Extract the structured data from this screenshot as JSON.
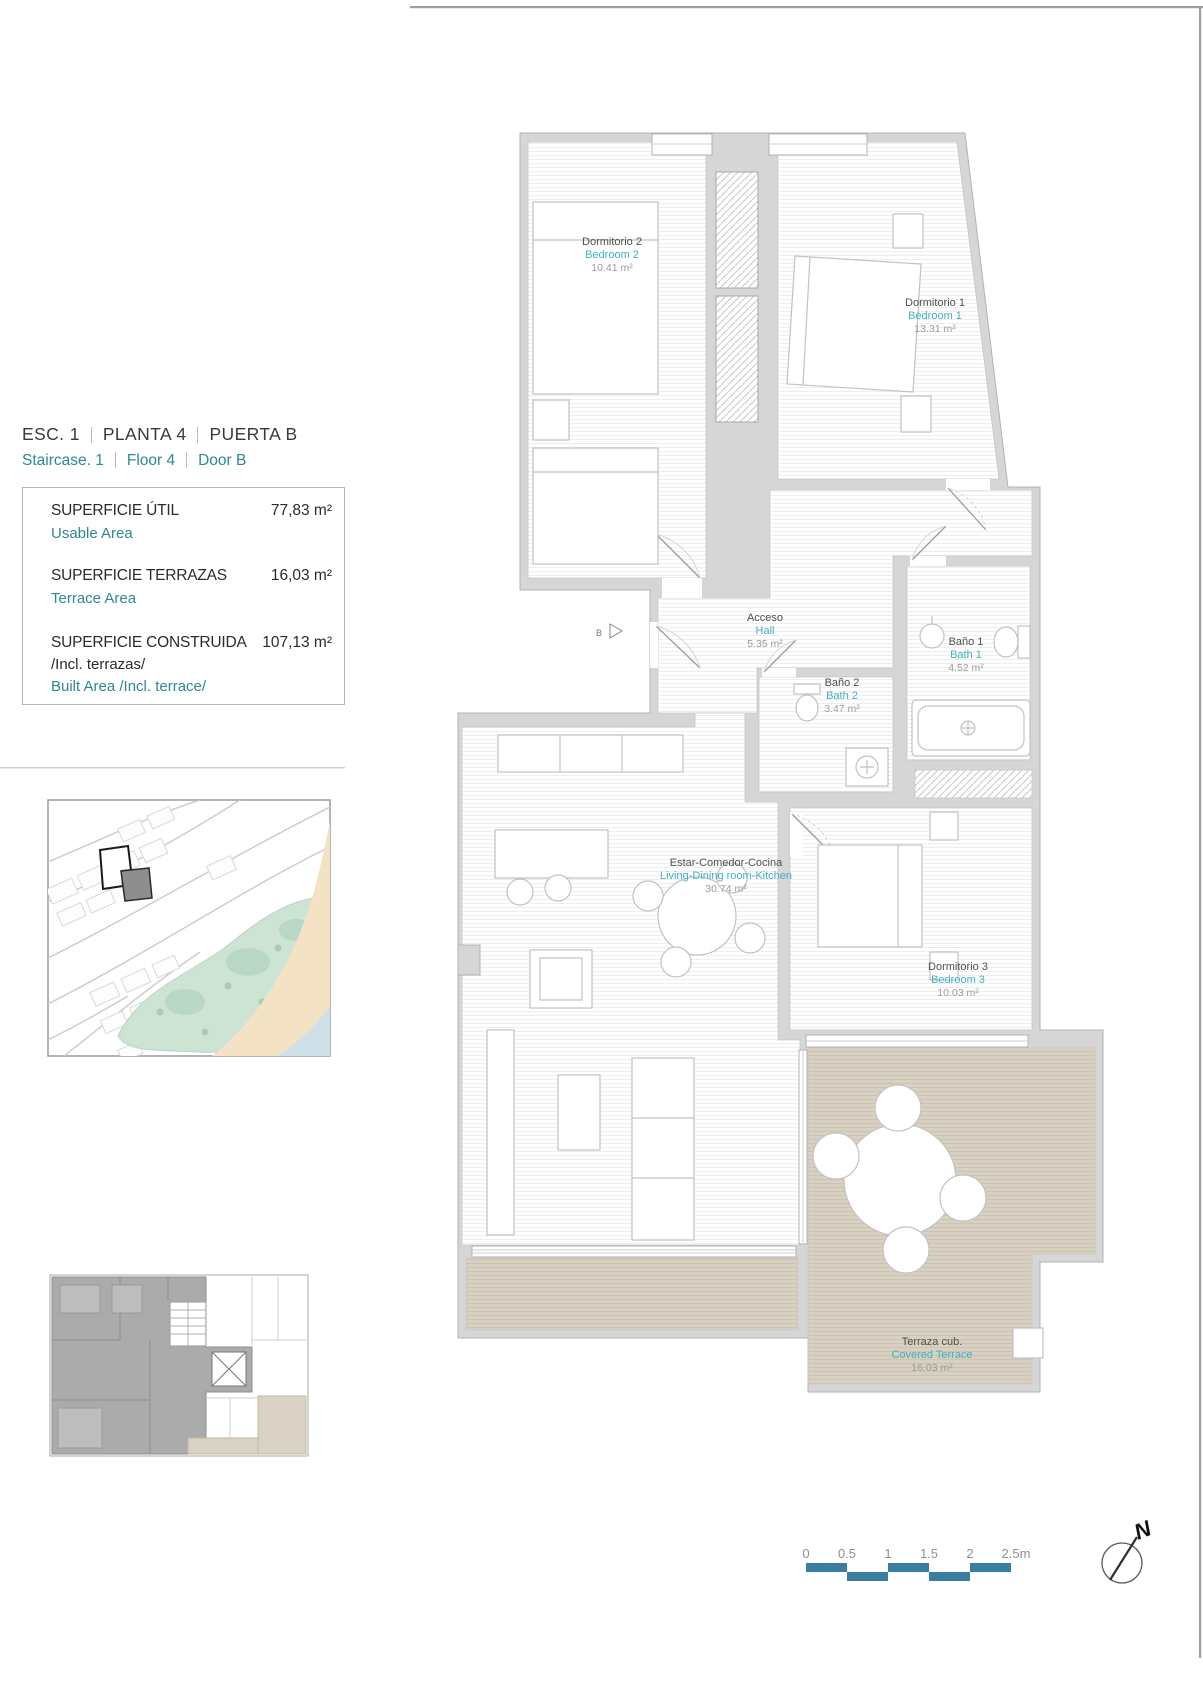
{
  "header": {
    "line_es": [
      "ESC.  1",
      "PLANTA   4",
      "PUERTA  B"
    ],
    "line_en": [
      "Staircase.  1",
      "Floor   4",
      "Door  B"
    ]
  },
  "areas": {
    "rows": [
      {
        "label_es": "SUPERFICIE ÚTIL",
        "label_en": "Usable Area",
        "value": "77,83 m²"
      },
      {
        "label_es": "SUPERFICIE TERRAZAS",
        "label_en": "Terrace Area",
        "value": "16,03 m²"
      },
      {
        "label_es": "SUPERFICIE CONSTRUIDA",
        "label_es2": "/Incl. terrazas/",
        "label_en": "Built Area /Incl. terrace/",
        "value": "107,13 m²"
      }
    ]
  },
  "rooms": [
    {
      "id": "bedroom2",
      "name_es": "Dormitorio 2",
      "name_en": "Bedroom 2",
      "area": "10.41 m²"
    },
    {
      "id": "bedroom1",
      "name_es": "Dormitorio 1",
      "name_en": "Bedroom 1",
      "area": "13.31 m²"
    },
    {
      "id": "hall",
      "name_es": "Acceso",
      "name_en": "Hall",
      "area": "5.35 m²"
    },
    {
      "id": "bath1",
      "name_es": "Baño 1",
      "name_en": "Bath 1",
      "area": "4.52 m²"
    },
    {
      "id": "bath2",
      "name_es": "Baño 2",
      "name_en": "Bath 2",
      "area": "3.47 m²"
    },
    {
      "id": "living",
      "name_es": "Estar-Comedor-Cocina",
      "name_en": "Living-Dining room-Kitchen",
      "area": "30.74 m²"
    },
    {
      "id": "bedroom3",
      "name_es": "Dormitorio 3",
      "name_en": "Bedroom 3",
      "area": "10.03 m²"
    },
    {
      "id": "terrace",
      "name_es": "Terraza cub.",
      "name_en": "Covered Terrace",
      "area": "16.03 m²"
    }
  ],
  "plan": {
    "entry_label": "B"
  },
  "scalebar": {
    "ticks": [
      "0",
      "0.5",
      "1",
      "1.5",
      "2",
      "2.5m"
    ]
  },
  "compass": {
    "label": "N"
  },
  "colors": {
    "teal_text": "#2e8794",
    "cyan_room_text": "#41b1c2",
    "wall_gray": "#d6d6d6",
    "terrace_beige": "#d8d0c2",
    "scalebar": "#3a7fa0",
    "park_green": "#cde3d4",
    "sand": "#f3e3c4",
    "water": "#cfe0e8",
    "highlight_building": "#8e8e8e"
  }
}
